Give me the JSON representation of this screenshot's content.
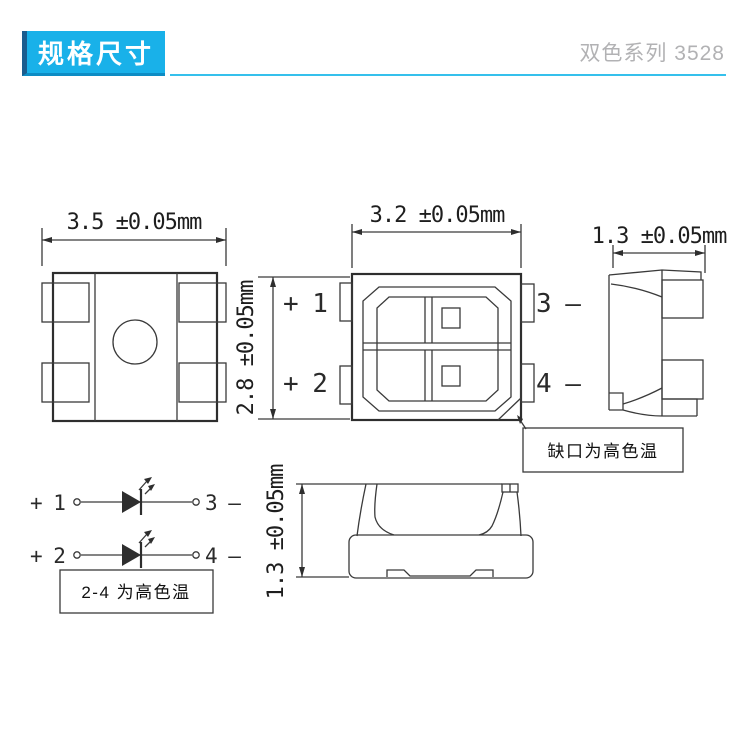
{
  "header": {
    "badge_label": "规格尺寸",
    "series_label": "双色系列 3528",
    "accent_color": "#19b1e9"
  },
  "dimensions": {
    "bottom_view_width": "3.5 ±0.05mm",
    "top_view_width": "3.2 ±0.05mm",
    "top_view_height": "2.8 ±0.05mm",
    "side_view_depth": "1.3 ±0.05mm",
    "front_view_height": "1.3 ±0.05mm"
  },
  "top_view_pins": {
    "pin1": "+ 1",
    "pin2": "+ 2",
    "pin3": "3 —",
    "pin4": "4 —"
  },
  "circuit": {
    "pin1": "+ 1",
    "pin2": "+ 2",
    "pin3": "3 —",
    "pin4": "4 —"
  },
  "notes": {
    "notch": "缺口为高色温",
    "polarity": "2-4 为高色温"
  }
}
